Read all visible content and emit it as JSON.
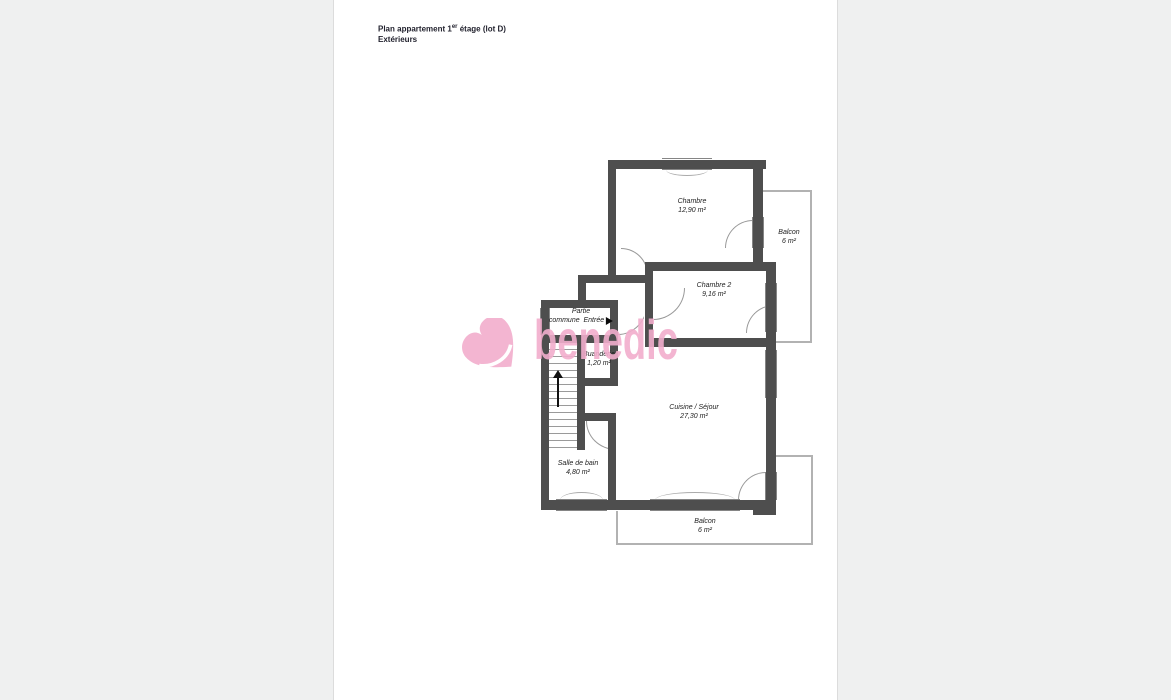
{
  "header": {
    "title_main": "Plan appartement 1",
    "title_sup": "er",
    "title_rest": " étage (lot D)",
    "subtitle": "Extérieurs"
  },
  "watermark": {
    "text": "benedic",
    "color": "#f2aecd"
  },
  "labels": {
    "chambre": {
      "name": "Chambre",
      "area": "12,90 m²"
    },
    "chambre2": {
      "name": "Chambre 2",
      "area": "9,16 m²"
    },
    "balcon_haut": {
      "name": "Balcon",
      "area": "6 m²"
    },
    "balcon_bas": {
      "name": "Balcon",
      "area": "6 m²"
    },
    "buanderie": {
      "name": "Buanderie",
      "area": "1,20 m²"
    },
    "cuisine": {
      "name": "Cuisine / Séjour",
      "area": "27,30 m²"
    },
    "salle_de_bain": {
      "name": "Salle de bain",
      "area": "4,80 m²"
    },
    "partie_commune": {
      "line1": "Partie",
      "line2": "commune",
      "entree": "Entrée"
    }
  },
  "colors": {
    "wall": "#4e4e4e",
    "balcony_outline": "#b2b2b2",
    "watermark_pink": "#f2aecd",
    "page_background": "#ffffff",
    "canvas_background": "#eff0f0"
  }
}
